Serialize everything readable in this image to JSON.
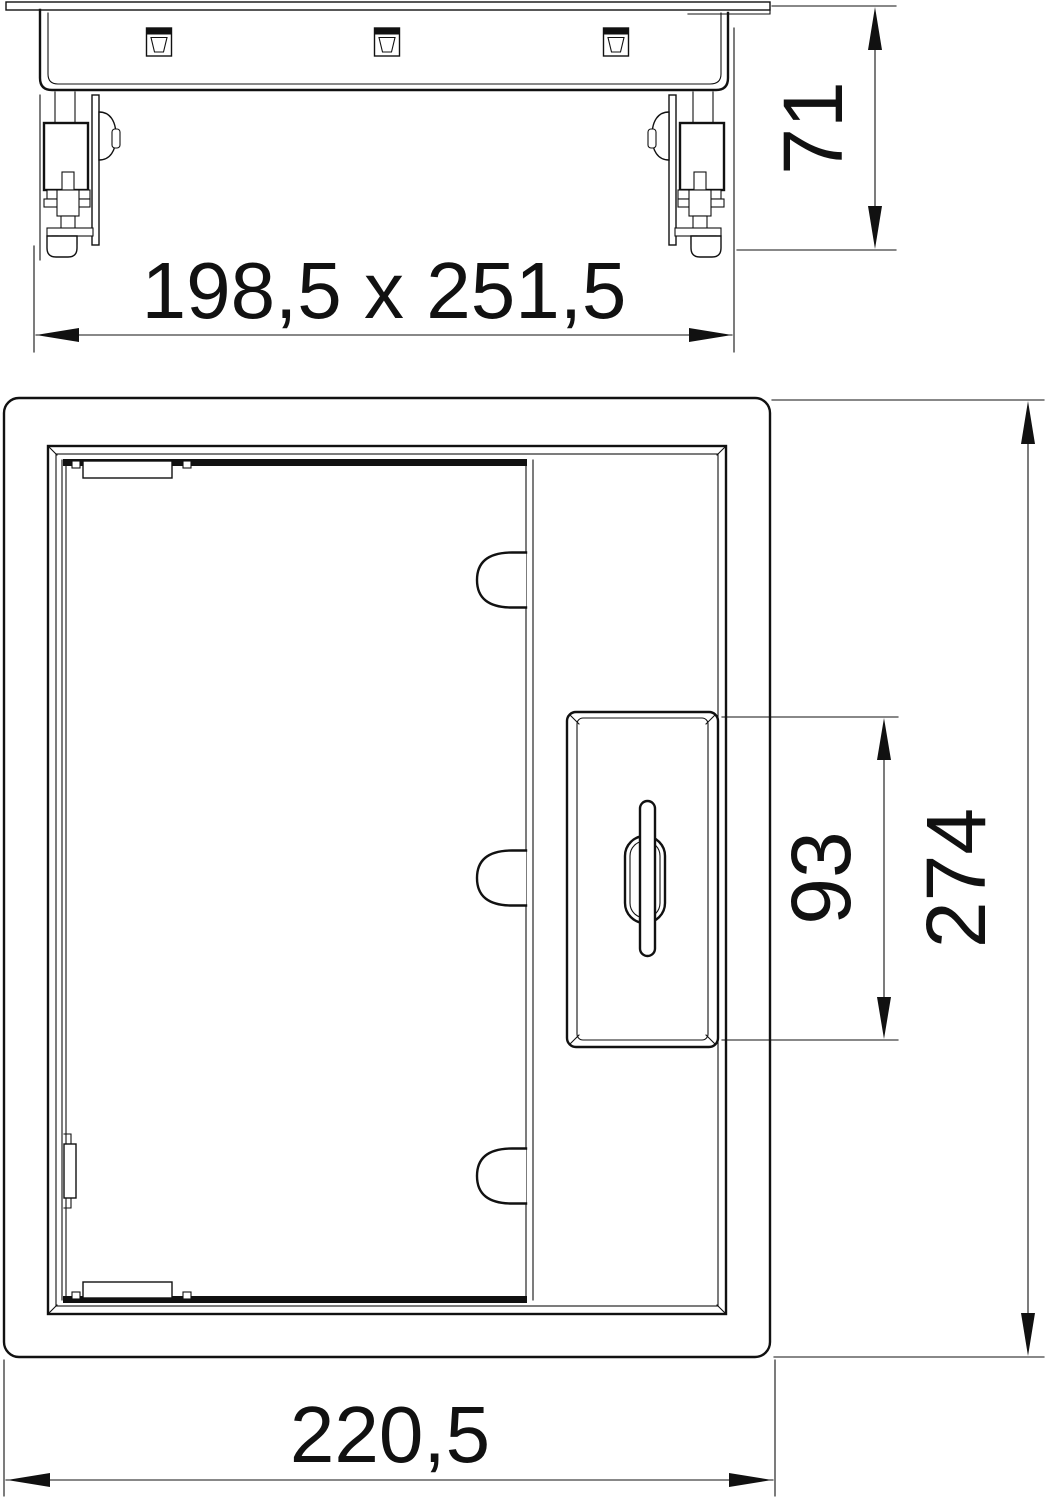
{
  "drawing": {
    "kind": "technical-dimension-drawing",
    "colors": {
      "line": "#111111",
      "background": "#ffffff"
    },
    "views": {
      "side_view": {
        "name": "side elevation"
      },
      "plan_view": {
        "name": "plan view"
      }
    },
    "dimensions": {
      "side_height": {
        "label": "71"
      },
      "floor_cutout": {
        "label": "198,5 x 251,5"
      },
      "blind_plate": {
        "label": "93"
      },
      "unit_length": {
        "label": "274"
      },
      "unit_width": {
        "label": "220,5"
      }
    }
  }
}
